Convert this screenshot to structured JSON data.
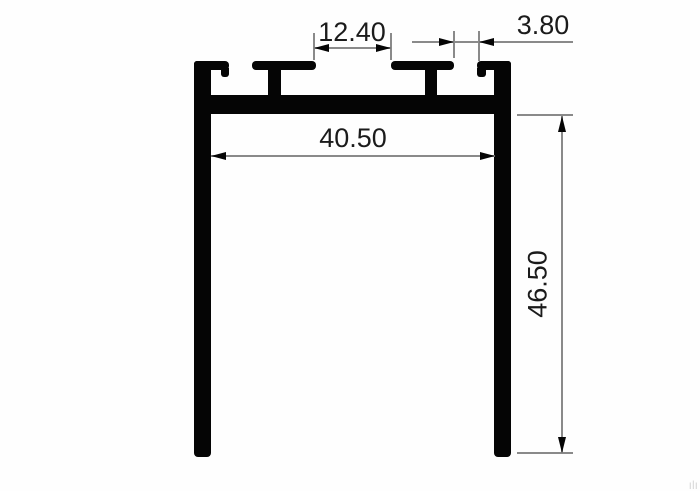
{
  "diagram": {
    "type": "technical-drawing",
    "subject": "aluminum-extrusion-profile-cross-section",
    "dimensions": {
      "center_slot_opening": {
        "label": "12.40",
        "orientation": "horizontal"
      },
      "side_slot_opening": {
        "label": "3.80",
        "orientation": "horizontal"
      },
      "inner_width": {
        "label": "40.50",
        "orientation": "horizontal"
      },
      "leg_height": {
        "label": "46.50",
        "orientation": "vertical"
      }
    },
    "colors": {
      "profile": "#050505",
      "dimension_lines": "#8a8a8a",
      "text": "#1b1b1b",
      "background": "#ffffff"
    },
    "watermark": "ılı"
  }
}
